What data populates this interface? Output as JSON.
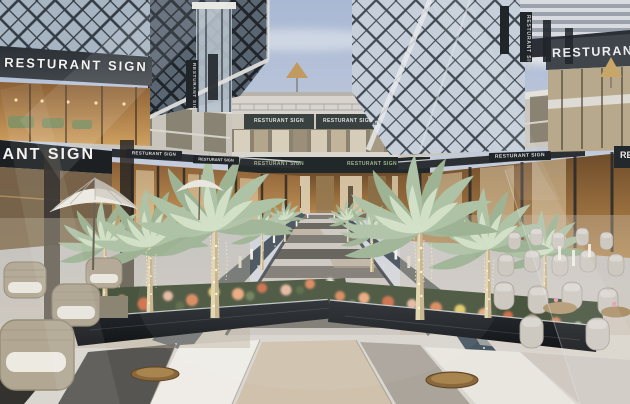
{
  "signs": {
    "top_left": "RESTURANT SIGN",
    "left_mid": "RESTURANT SIGN",
    "top_right": "RESTURANT SIGN",
    "right_mid": "RESTURANT SIGN",
    "right_band": "RESTURANT SIGN",
    "right_edge": "RESTURANT SIGN",
    "far_upper_left": "RESTURANT SIGN",
    "far_upper_right": "RESTURANT SIGN",
    "far_fascia_left": "RESTURANT SIGN",
    "far_fascia_right": "RESTURANT SIGN",
    "canopy_left_1": "RESTURANT SIGN",
    "canopy_left_2": "RESTURANT SIGN",
    "blade_left": "RESTURANT SIGN",
    "blade_right": "RESTURANT SIGN"
  },
  "palette": {
    "sky_top": "#a9b8d4",
    "sky_horizon": "#e8e1d8",
    "sign_band": "#23272c",
    "sign_text": "#f2f2f0",
    "warm_interior": "#b9894e",
    "palm_foliage": "#b6c7ae",
    "flowers_coral": "#d9895d",
    "planter_stone": "#17191d",
    "floor_marble": "#d9d5cf",
    "floor_beige": "#cbb9a0",
    "floor_dark": "#3f3e3b",
    "diagrid_frame": "#2c3238",
    "chair_upholstery": "#cdc9c1"
  }
}
